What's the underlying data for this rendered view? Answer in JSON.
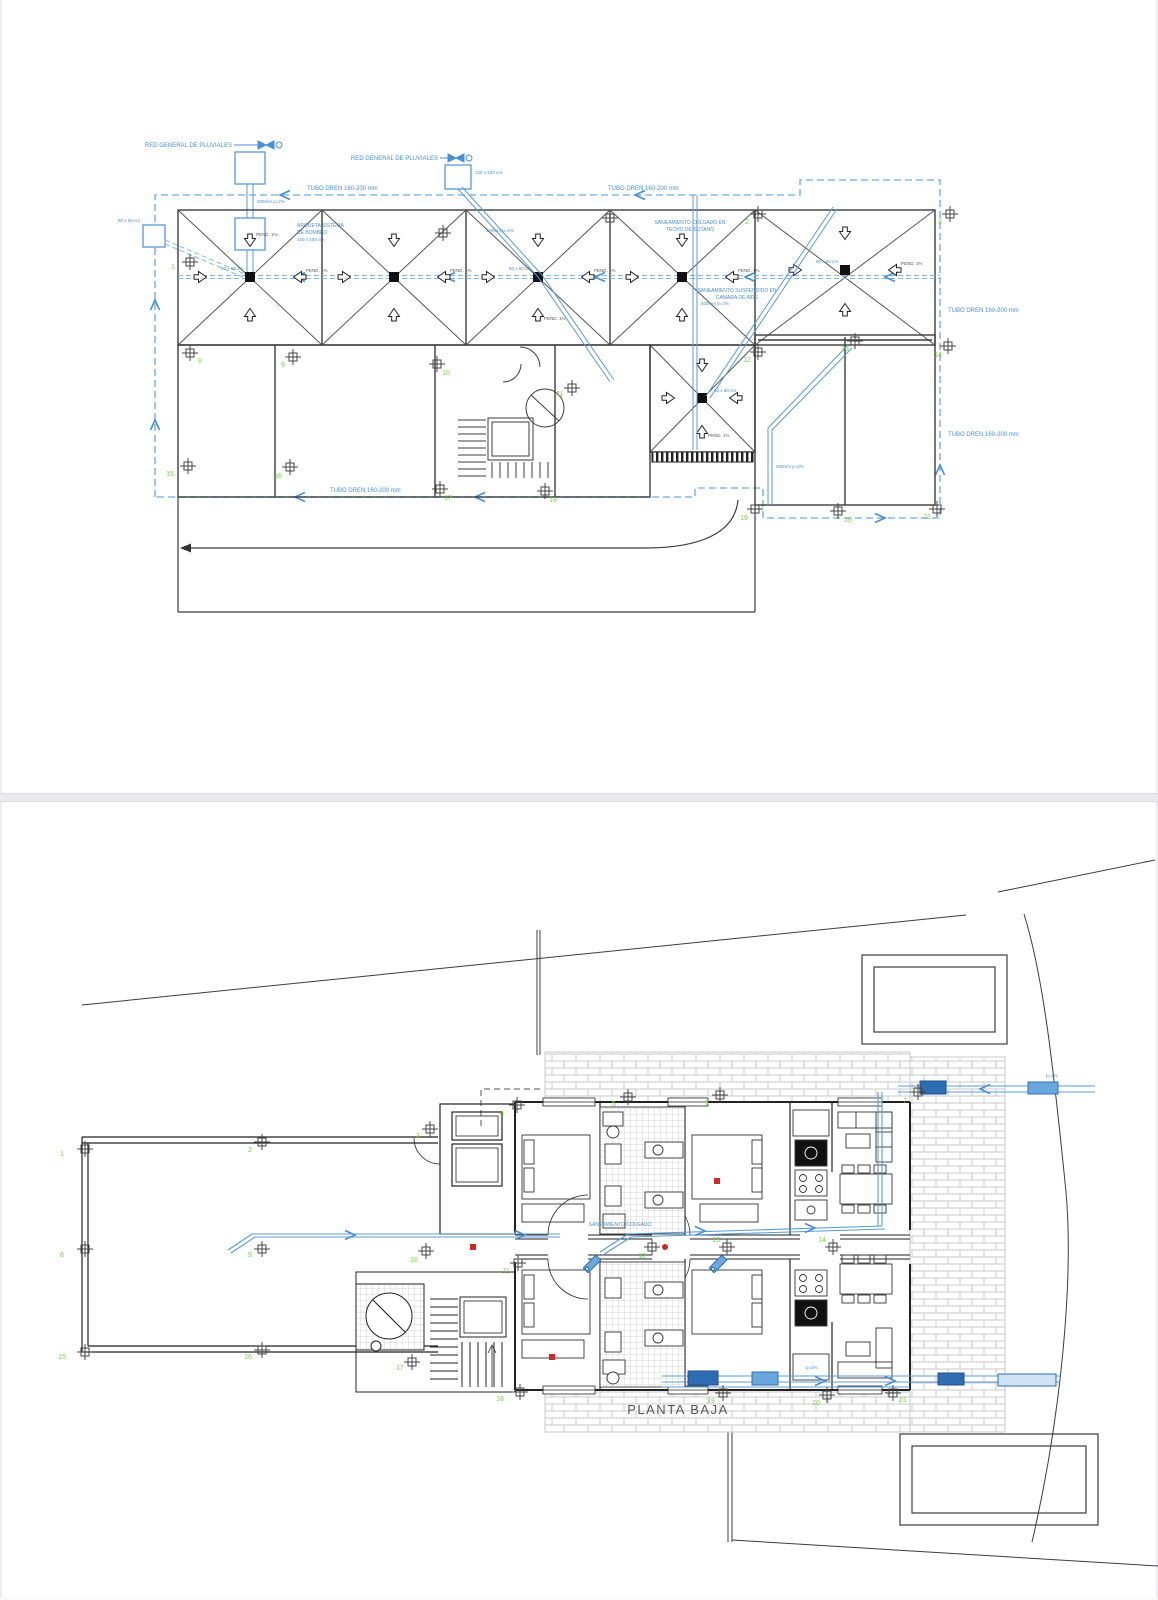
{
  "roof_plan": {
    "red_general": "RED GENERAL DE PLUVIALES",
    "tubo_dren": "TUBO DREN 160-200 mm",
    "arqueta_l1": "ARQUETA SISTEMA",
    "arqueta_l2": "DE BOMBEO",
    "arqueta_l3": "100 x 100 cm",
    "arqueta2_size": "100 x 100 cm",
    "arqueta3_size": "50 x 50 cm",
    "colgado_l1": "SANEAMIENTO COLGADO EN",
    "colgado_l2": "TECHO DE SOTANO",
    "suspendido_l1": "SANEAMIENTO SUSPENDIDO EN",
    "suspendido_l2": "CAMARA DE AIRE",
    "pend": "PEND. 1%",
    "drain_size": "60 x 60 cm",
    "pipe_spec": "200mm p=2%",
    "markers": [
      "1",
      "2",
      "3",
      "8",
      "9",
      "10",
      "11",
      "12",
      "13",
      "14",
      "15",
      "16",
      "17",
      "18",
      "19",
      "20",
      "21"
    ]
  },
  "ground_plan": {
    "title": "PLANTA BAJA",
    "pipe_label": "SANEAMIENTO COLGADO",
    "pipe_spec": "p=2%",
    "markers": [
      "1",
      "2",
      "3",
      "4",
      "5",
      "6",
      "7",
      "8",
      "9",
      "10",
      "11",
      "12",
      "13",
      "14",
      "15",
      "16",
      "17",
      "18",
      "19",
      "20",
      "21"
    ]
  },
  "colors": {
    "pipe_blue": "#5b9bd5",
    "dren_blue": "#85b8e8",
    "fitting_blue": "#2e6db4",
    "marker_green": "#7bcf4a",
    "alert_red": "#cc2a2a"
  }
}
